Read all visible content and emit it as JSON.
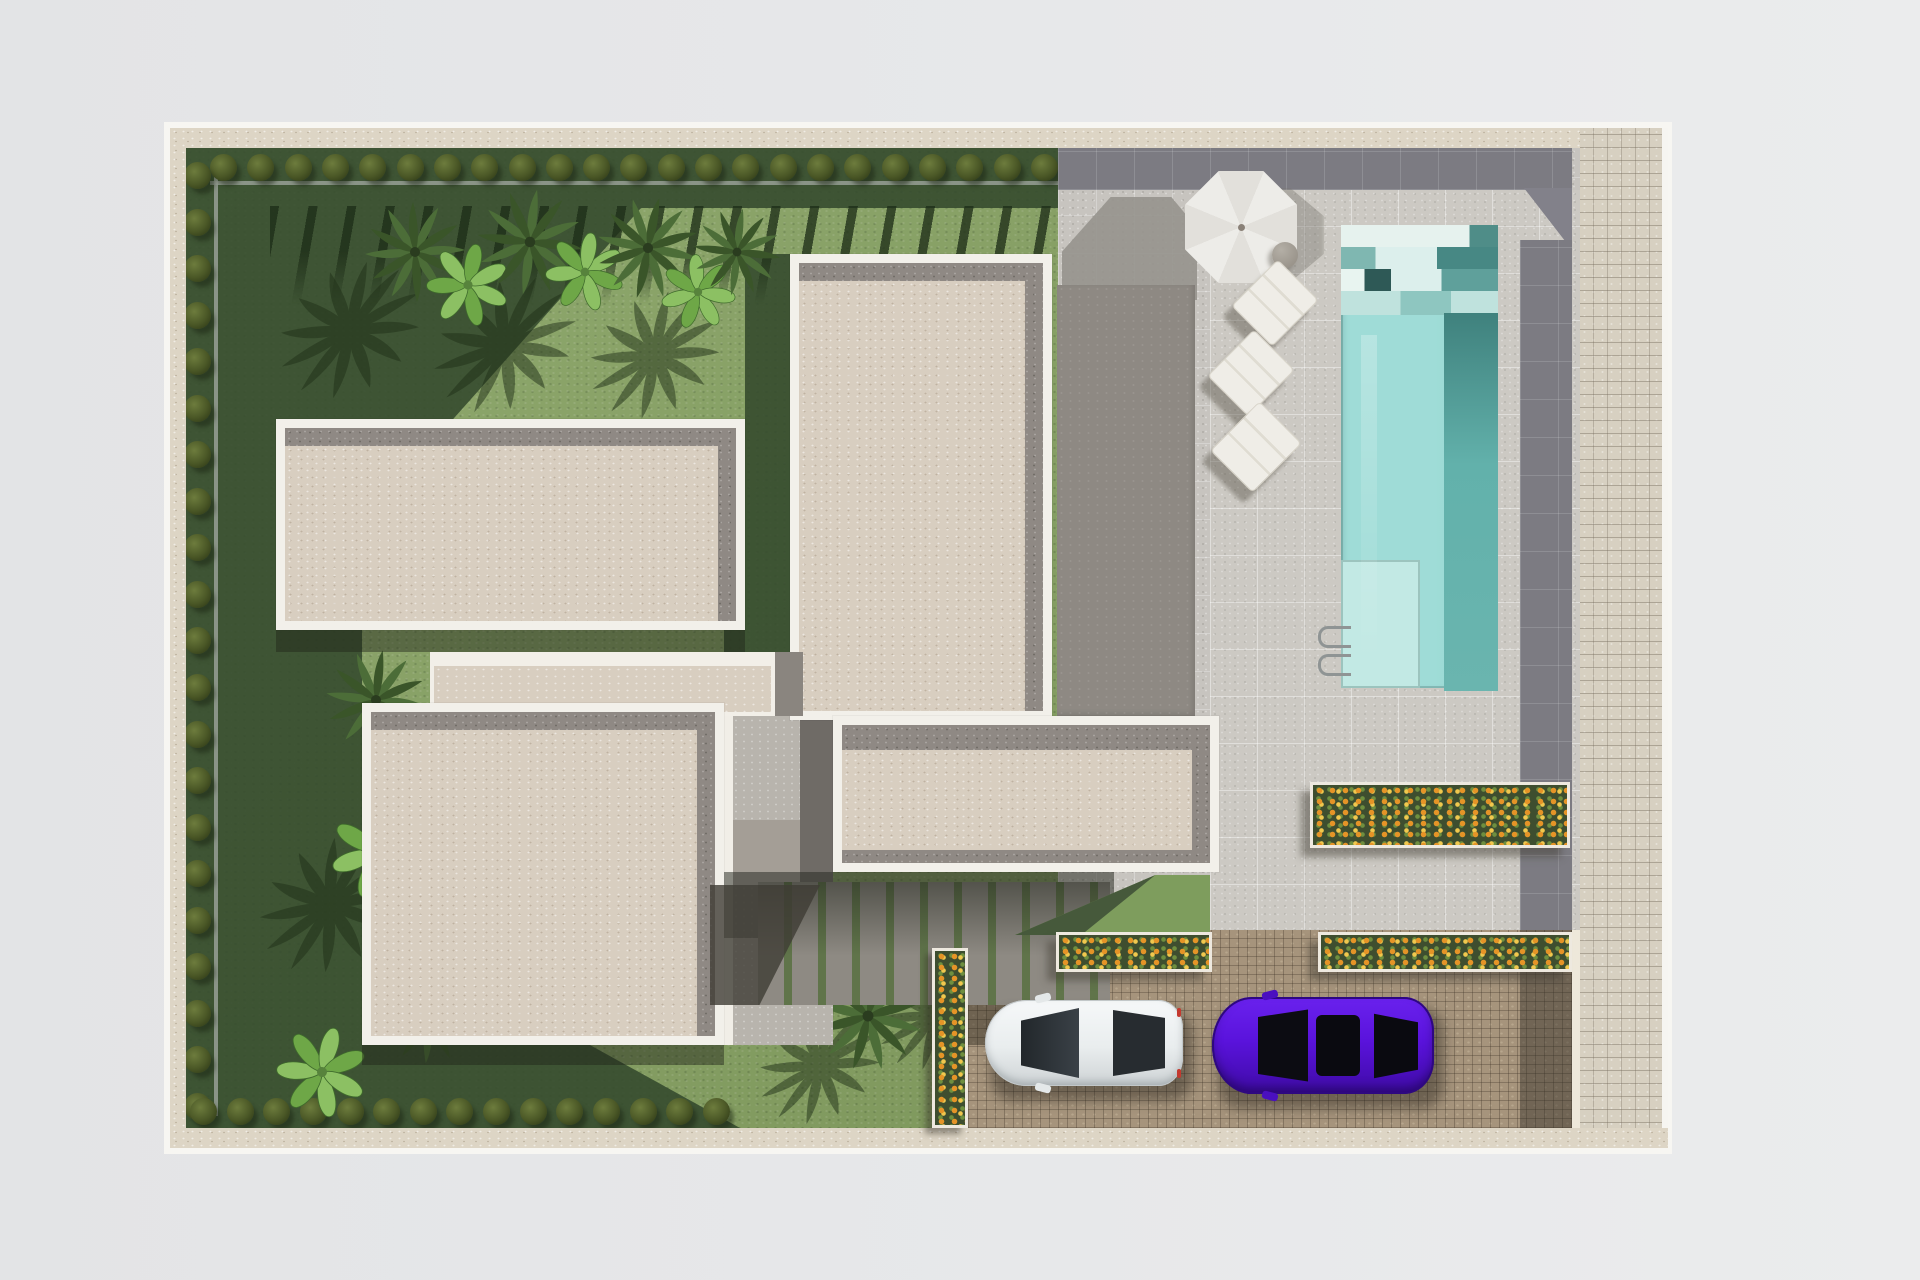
{
  "scene": {
    "description": "Top-down 3D architectural site plan rendering of a modern single-family villa plot with garden, pool terrace and driveway",
    "view": "top-down orthographic render",
    "visible_text": "none",
    "aria": {
      "plan": "Villa site plan, top view 3D render",
      "garden": "Lawn garden with palm trees, banana plants and boxwood hedge rows",
      "terrace": "Paved pool terrace with parasol and sun loungers",
      "pool": "Rectangular swimming pool with entry steps, deep lane and ladder",
      "driveway": "Cobblestone driveway with two parked cars",
      "sidewalk": "Cobblestone sidewalk strip along the right boundary",
      "garage": "Flat gray secondary roof between house and terrace",
      "house": "Flat-roofed villa volumes with white parapets and gravel roofs"
    }
  },
  "palette": {
    "background": "#e6e7e9",
    "boundary_wall": "#ddd5c5",
    "lawn_sun": "#87a263",
    "lawn_shadow": "#33492c",
    "roof_beige": "#d8cec0",
    "roof_border_gray": "#8f8984",
    "parapet_white": "#f2f0ea",
    "terrace_tile": "#c7c4bf",
    "terrace_band_dark": "#7c7b82",
    "garage_roof_gray": "#8e8983",
    "pool_water": "#9fdcd7",
    "pool_deep": "#57a5a0",
    "pool_steps_light": "#e8f4f0",
    "driveway_cobble": "#a6947c",
    "sidewalk_cobble": "#d7d0c1",
    "flowers_orange": "#e59427",
    "flowers_yellow": "#f0c84e",
    "car_white": "#e9edee",
    "car_purple": "#5a13dc",
    "umbrella_white": "#eae8e3"
  },
  "objects": {
    "buildings": [
      {
        "id": "upper-left-wing",
        "roof": "beige gravel, white parapet"
      },
      {
        "id": "lower-left-wing",
        "roof": "beige gravel, white parapet"
      },
      {
        "id": "tall-central-wing",
        "roof": "beige gravel, white parapet"
      },
      {
        "id": "rear-wing",
        "roof": "beige gravel, white parapet"
      },
      {
        "id": "garage-roof",
        "roof": "plain gray"
      },
      {
        "id": "connector-corridor",
        "roof": "beige gravel"
      }
    ],
    "pool": {
      "shape": "rectangle",
      "features": [
        "staggered entry steps",
        "dark deep lane",
        "shallow shelf",
        "ladder"
      ]
    },
    "furniture": {
      "umbrella_count": 1,
      "lounger_count": 3,
      "side_table_count": 1
    },
    "cars": [
      {
        "color_name": "white",
        "facing": "left"
      },
      {
        "color_name": "purple",
        "facing": "left"
      }
    ],
    "planters": {
      "count": 4,
      "flower_colors": [
        "orange",
        "yellow"
      ]
    },
    "hedges": {
      "top": {
        "count": 23
      },
      "left": {
        "count": 21
      },
      "bottom": {
        "count": 15
      }
    },
    "trees": {
      "palms": 9,
      "banana_plants": 5
    },
    "walkway": {
      "type": "striped pavers with grass joints"
    }
  }
}
